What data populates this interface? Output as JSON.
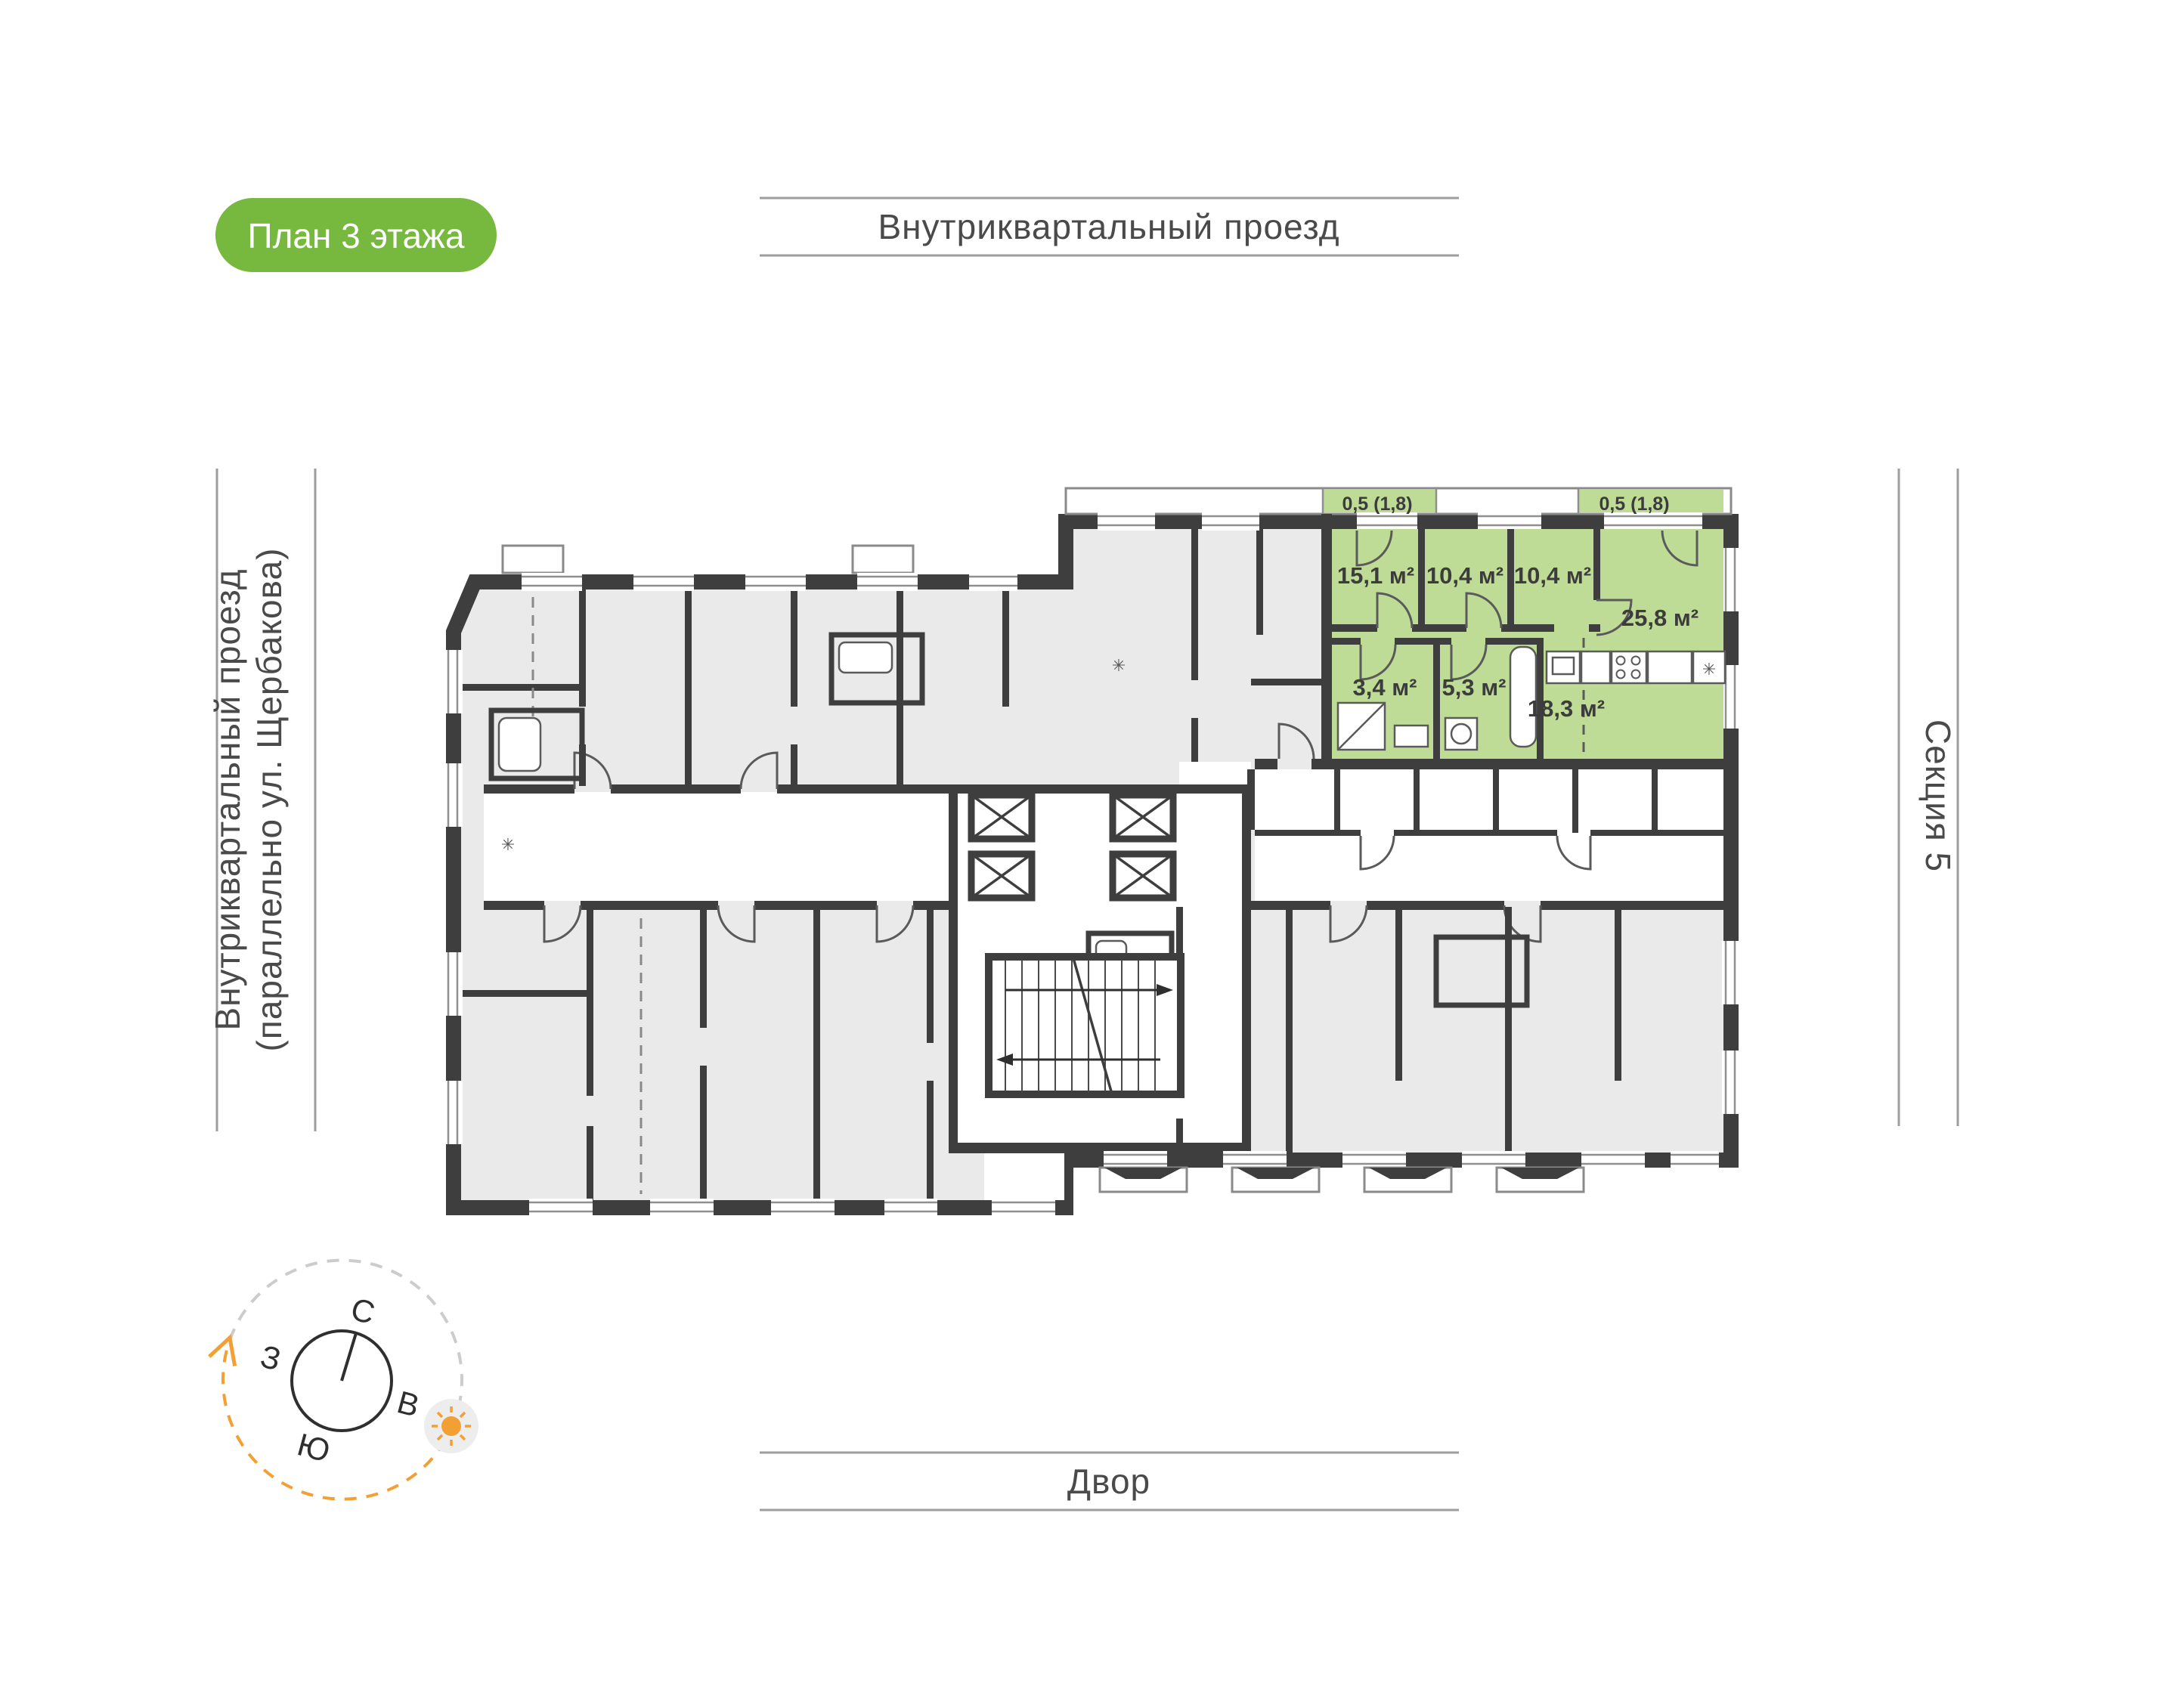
{
  "badge": {
    "label": "План 3 этажа"
  },
  "labels": {
    "top_street": "Внутриквартальный проезд",
    "left_street_line1": "Внутриквартальный проезд",
    "left_street_line2": "(параллельно ул. Щербакова)",
    "right_section": "Секция 5",
    "bottom_yard": "Двор"
  },
  "compass": {
    "north": "С",
    "east": "В",
    "south": "Ю",
    "west": "З"
  },
  "apartment": {
    "rooms": [
      {
        "name": "bedroom-1",
        "area": "15,1 м²"
      },
      {
        "name": "bedroom-2",
        "area": "10,4 м²"
      },
      {
        "name": "bedroom-3",
        "area": "10,4 м²"
      },
      {
        "name": "living-room",
        "area": "25,8 м²"
      },
      {
        "name": "bathroom-1",
        "area": "3,4 м²"
      },
      {
        "name": "bathroom-2",
        "area": "5,3 м²"
      },
      {
        "name": "hallway",
        "area": "18,3 м²"
      }
    ],
    "balconies": [
      {
        "area": "0,5 (1,8)"
      },
      {
        "area": "0,5 (1,8)"
      }
    ]
  },
  "colors": {
    "badge_bg": "#76b93e",
    "apartment_highlight": "#bedc96",
    "wall": "#3e3e3e",
    "apartment_gray": "#eaeaea",
    "street_line": "#9e9e9e",
    "text_gray": "#4a4a4a",
    "compass_orange": "#f2a033"
  }
}
